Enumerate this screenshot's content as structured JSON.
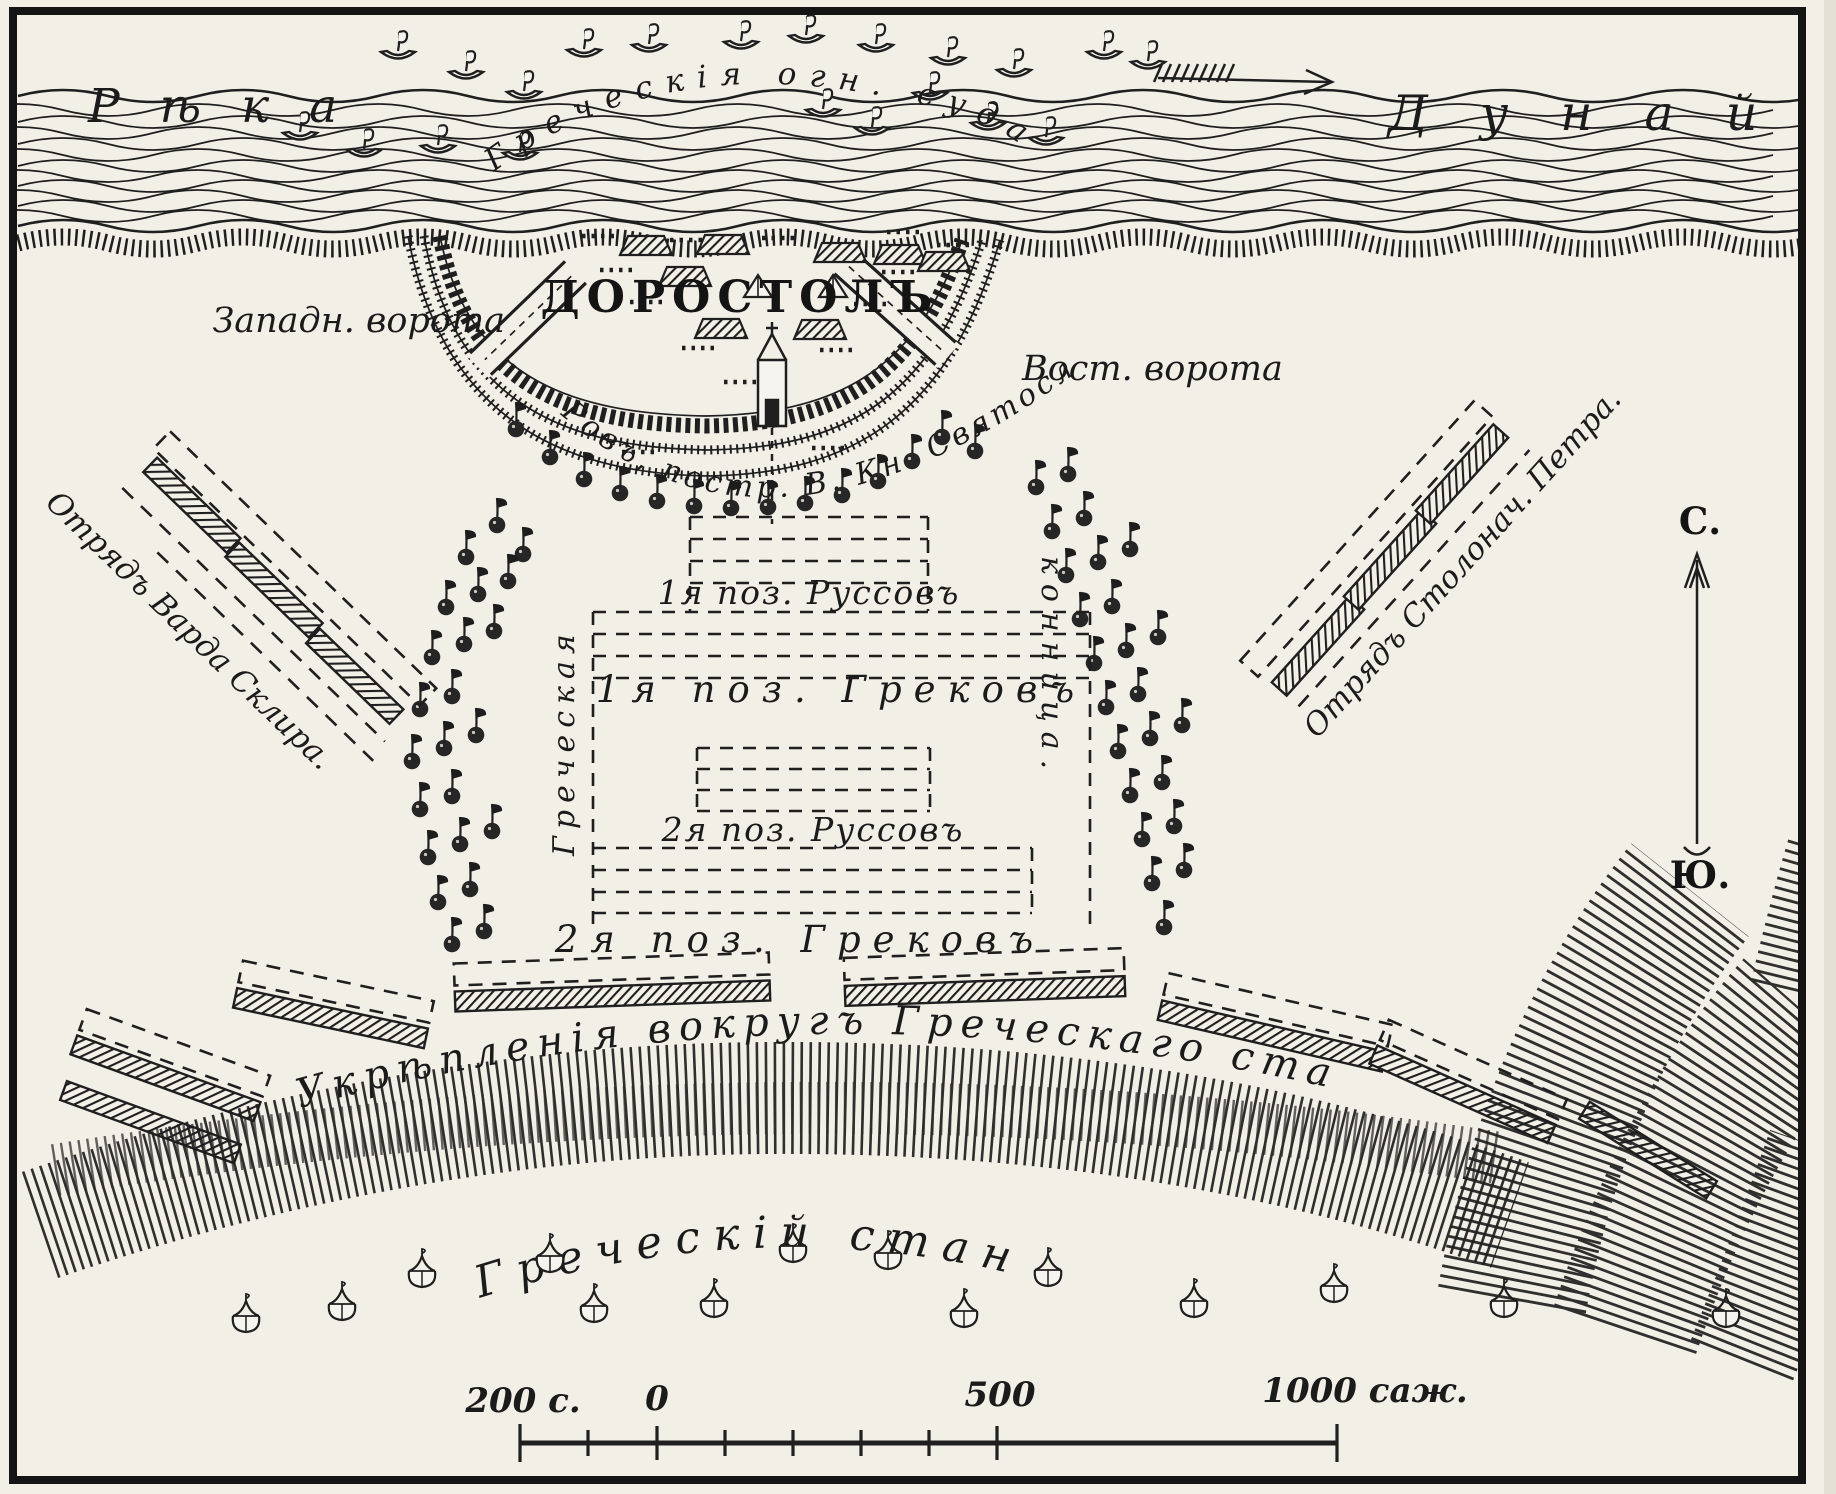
{
  "river": {
    "label_left": "Рѣка",
    "label_right": "Дунай",
    "ships_label": "Греческія огн. суда"
  },
  "city": {
    "name": "ДОРОСТОЛЪ",
    "west_gate": "Западн. ворота",
    "east_gate": "Вост. ворота",
    "moat_label": "Ровъ, постр. В. Кн. Святославомъ."
  },
  "formations": {
    "rus_1": "1я поз. Руссовъ",
    "greek_1": "1я поз. Грековъ",
    "rus_2": "2я поз. Руссовъ",
    "greek_2": "2я поз. Грековъ",
    "cavalry_left": "Греческая",
    "cavalry_right": "конница."
  },
  "detachments": {
    "left": "Отрядъ Варда Склира.",
    "right": "Отрядъ Столонач. Петра."
  },
  "camp": {
    "fortifications_label": "Укрѣпленія вокругъ Греческаго стана",
    "name": "Греческій станъ"
  },
  "compass": {
    "north": "С.",
    "south": "Ю."
  },
  "scale_bar": {
    "label_200": "200 с.",
    "label_0": "0",
    "label_500": "500",
    "label_1000": "1000 саж."
  },
  "icons": {
    "boat": "sailboat-glyph",
    "unit_flag": "banner-with-circle",
    "tent": "round-tent-glyph",
    "house": "hatched-house-glyph",
    "flow_arrow": "feathered-arrow-right",
    "compass_arrow": "vertical-north-arrow"
  },
  "colors": {
    "ink": "#1f1f1f",
    "paper": "#f2efe7"
  }
}
